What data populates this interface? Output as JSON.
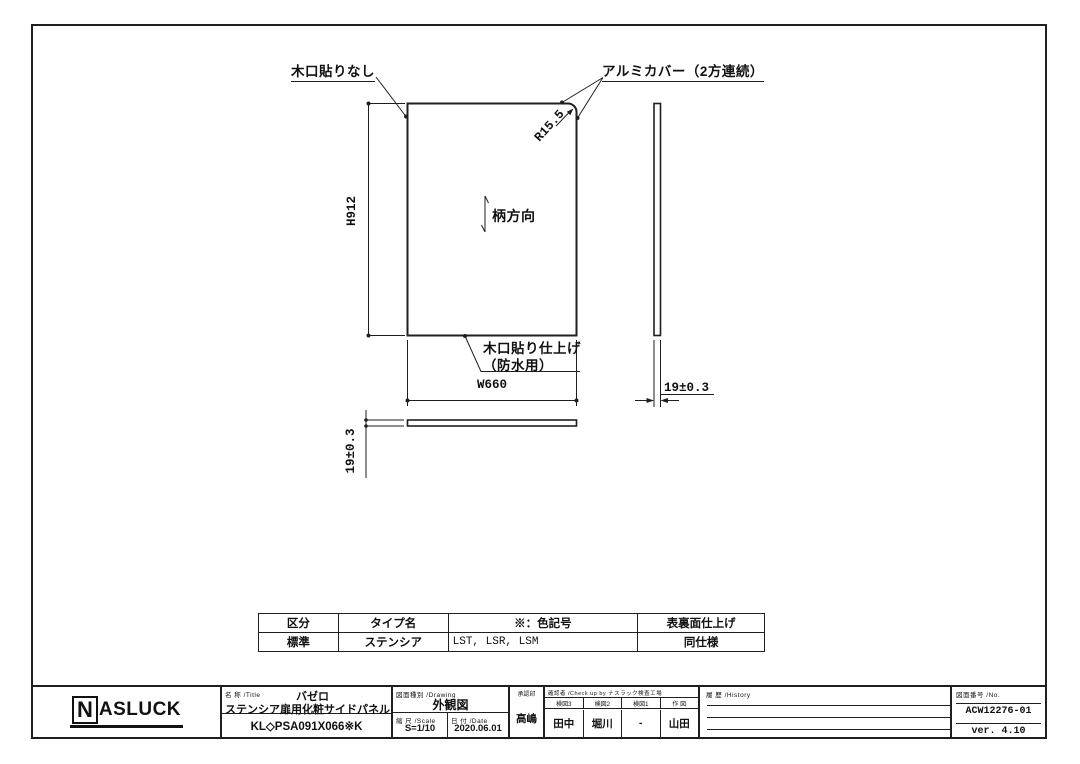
{
  "drawing": {
    "labels": {
      "edge_no_band": "木口貼りなし",
      "alumi_cover": "アルミカバー（2方連続）",
      "corner_radius": "R15.5",
      "height_dim": "H912",
      "grain_direction": "柄方向",
      "edge_band_finish_line1": "木口貼り仕上げ",
      "edge_band_finish_line2": "（防水用）",
      "width_dim": "W660",
      "thickness_dim_side": "19±0.3",
      "thickness_dim_bottom": "19±0.3"
    }
  },
  "spec_table": {
    "headers": [
      "区分",
      "タイプ名",
      "※：色記号",
      "表裏面仕上げ"
    ],
    "rows": [
      [
        "標準",
        "ステンシア",
        "LST, LSR, LSM",
        "同仕様"
      ]
    ]
  },
  "title_block": {
    "logo": {
      "n": "N",
      "rest": "ASLUCK"
    },
    "title_label": "名 称 /Title",
    "series": "バゼロ",
    "product_name": "ステンシア扉用化粧サイドパネル",
    "model_code": "KL◇PSA091X066※K",
    "drawing_type_label": "図面種別 /Drawing",
    "drawing_type": "外観図",
    "scale_label": "縮 尺 /Scale",
    "scale": "S=1/10",
    "date_label": "日 付 /Date",
    "date": "2020.06.01",
    "approval_label": "承認印",
    "approval": "高嶋",
    "check_label": "確認者 /Check up by ナスラック検査工場",
    "check_cols": [
      {
        "label": "検図3",
        "value": "田中"
      },
      {
        "label": "検図2",
        "value": "堀川"
      },
      {
        "label": "検図1",
        "value": "-"
      },
      {
        "label": "作 図",
        "value": "山田"
      }
    ],
    "history_label": "履 歴 /History",
    "number_label": "図面番号 /No.",
    "drawing_number": "ACW12276-01",
    "version": "ver. 4.10"
  }
}
